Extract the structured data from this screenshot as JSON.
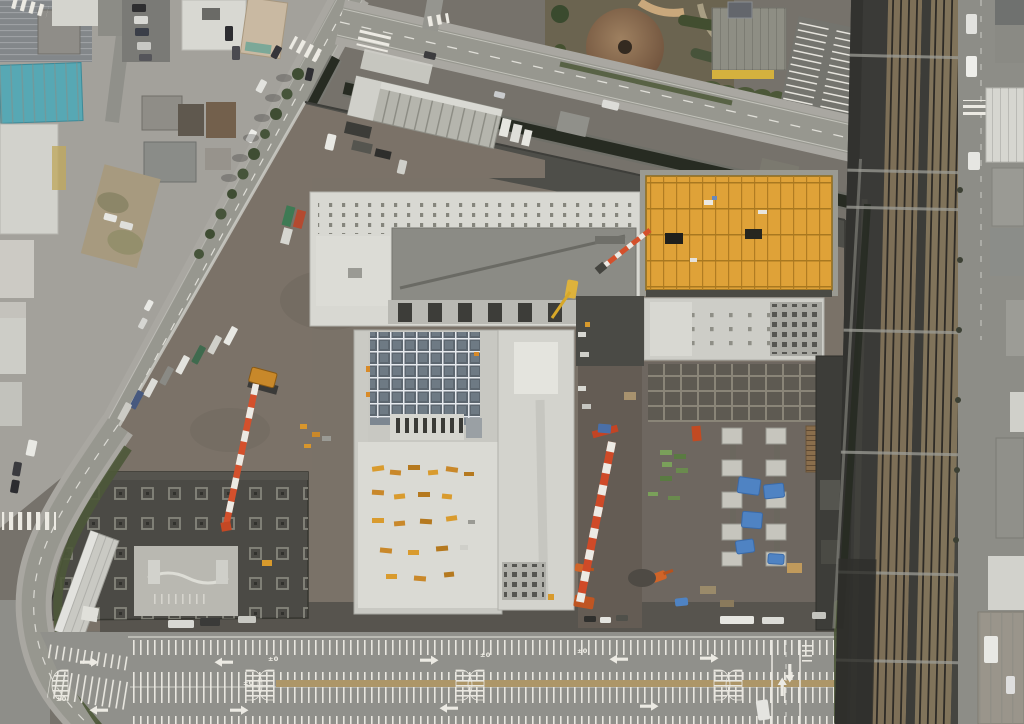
{
  "meta": {
    "type": "aerial-photograph",
    "subject": "Large urban construction site beside an elevated railway corridor",
    "view": "top-down orthographic drone view, daytime",
    "dimensions": "1024x724"
  },
  "markings": {
    "level_mark": "±0"
  },
  "scene": {
    "features": [
      "north-west city block with houses, shops and a teal-roofed warehouse",
      "tree-lined diagonal street with drainage canal",
      "wide boulevard running east toward the railway",
      "landscaped garden with circular brown pavilion roof",
      "building with yellow signage band and small parking rows (north-east)",
      "elevated railway corridor with two brown ballast double-tracks and overhead gantries",
      "east frontage street with pedestrian crossings and roadside buildings",
      "construction site: north concrete building with dotted roof anchors",
      "construction site: orange plywood formwork deck with grid and two openings",
      "construction site: white building with roof-dot grid south of the orange deck",
      "construction site: central building with blue-grey skylight grid and HVAC slot row",
      "construction site: central-west roof covered with yellow formwork stacks",
      "south-west foundation slab with column grid and light screed slab",
      "eastern excavation yard with concrete pile caps under blue tarps and green rebar stacks",
      "crawler cranes with red-and-white lattice booms, orange excavators",
      "temporary segmented-roof site warehouse along the canal",
      "row of site trucks parked along the west hoarding",
      "huge striped parking lot with lane arrows, hatched wedges, tan median and ±0 level marks",
      "curved south-west access road with hedge and white covered walkway"
    ]
  },
  "colors": {
    "base_ground": "#76726b",
    "urban_ground": "#a3a19b",
    "road_asphalt": "#97978f",
    "sidewalk": "#a9a7a1",
    "canal_water": "#272b22",
    "site_dirt": "#7a7268",
    "yard_dark": "#4e4e49",
    "concrete_white": "#d8d8d2",
    "concrete_mid": "#c4c4be",
    "roof_dark": "#8b8b85",
    "foundation_dark": "#4b4a45",
    "orange_deck": "#dfa238",
    "orange_line": "#ad7a22",
    "blue_grid": "#5d6770",
    "ballast_brown": "#7d6f57",
    "railway_dark": "#3a3a37",
    "teal_roof": "#57a8b4",
    "hedge_green": "#4c5838",
    "tarp_blue": "#4f83c3",
    "crane_red": "#d4502c",
    "machine_yellow": "#d89a2c",
    "parking_asphalt": "#90908b",
    "line_white": "#ebe9e2",
    "median_tan": "#ad9668",
    "dome_brown": "#8a6a50",
    "garden_bed": "#6b6450",
    "wood_deck": "#8a6e4c"
  }
}
